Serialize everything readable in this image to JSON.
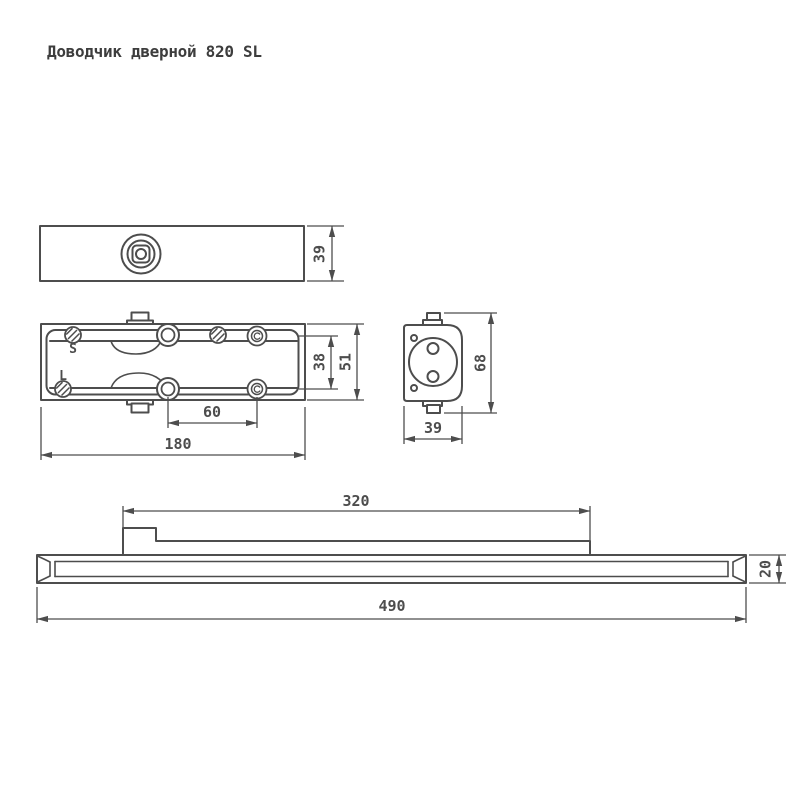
{
  "title": "Доводчик дверной 820 SL",
  "drawing": {
    "labels": {
      "spring_s": "S",
      "spring_l": "L"
    },
    "dims": {
      "top_width": "39",
      "plan_inner": "38",
      "plan_outer": "51",
      "plan_spacing": "60",
      "plan_length": "180",
      "end_height": "68",
      "end_width": "39",
      "rail_slider": "320",
      "rail_length": "490",
      "rail_height": "20"
    },
    "colors": {
      "line": "#4d4d4d",
      "background": "#ffffff"
    }
  }
}
